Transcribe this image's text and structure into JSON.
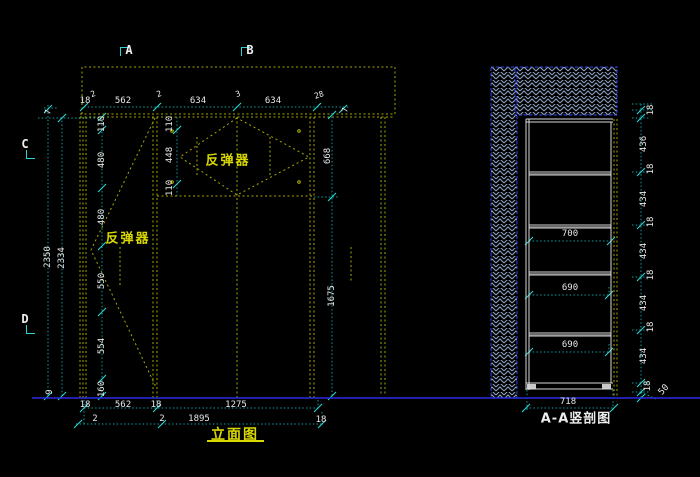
{
  "drawing": {
    "background": "#000000",
    "line_colors": {
      "frame_dashed": "#a8a800",
      "dimension": "#0e9b9b",
      "tick": "#2fd4d4",
      "section_outline": "#d9d9d9",
      "ground": "#2a2ae0",
      "hatch": "#93a7c4",
      "label_yellow": "#d8d800",
      "text_white": "#e8e8e8"
    }
  },
  "elevation": {
    "label": "立面图",
    "rebounder": "反弹器",
    "markers": [
      "A",
      "B",
      "C",
      "D"
    ],
    "top_dims": [
      "18",
      "2",
      "562",
      "2",
      "634",
      "3",
      "634",
      "28",
      "7"
    ],
    "left_outer_dims": [
      "7",
      "2350",
      "2334",
      "9"
    ],
    "left_inner_dims": [
      "110",
      "480",
      "480",
      "550",
      "554",
      "160"
    ],
    "top_cabinet_dims": [
      "110",
      "448",
      "110"
    ],
    "right_dims": [
      "668",
      "1675"
    ],
    "bottom_dims_row1": [
      "18",
      "562",
      "18",
      "1275"
    ],
    "bottom_dims_row2": [
      "2",
      "2",
      "1895",
      "18"
    ]
  },
  "section": {
    "label": "A-A竖剖图",
    "width_dims": [
      "700",
      "690",
      "690",
      "718"
    ],
    "right_chain": [
      "18",
      "436",
      "18",
      "434",
      "18",
      "434",
      "18",
      "434",
      "18",
      "434",
      "18",
      "50"
    ]
  }
}
